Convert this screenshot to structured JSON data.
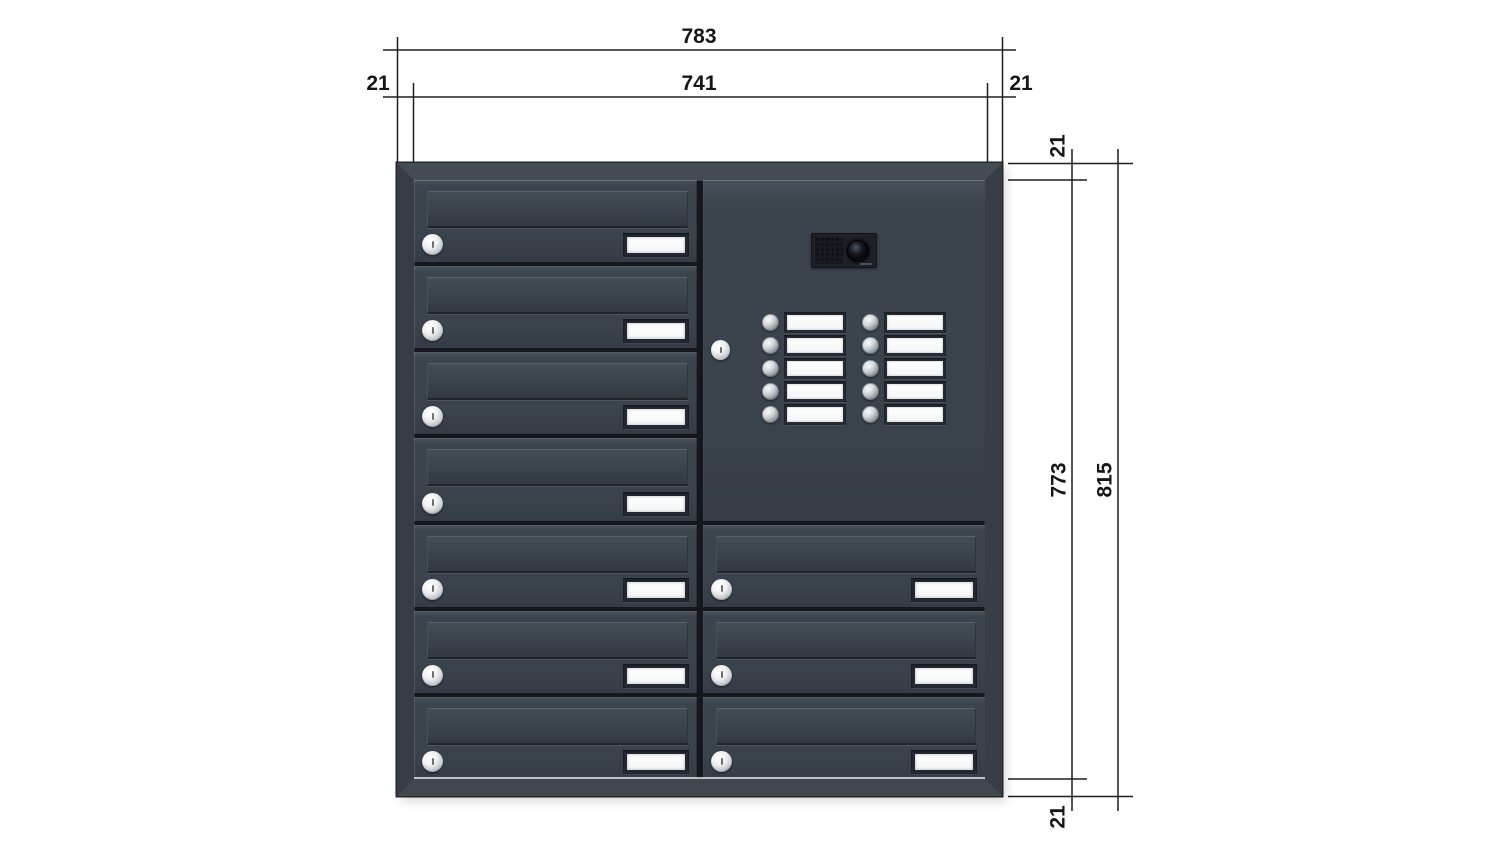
{
  "diagram": {
    "title": "mailbox-unit-dimensioned-drawing",
    "description": "Anthracite wall letterbox bank: 7 mailbox doors left column, intercom panel with camera and 10 bell buttons plus 3 mailbox doors right column, with dimension annotations"
  },
  "dimensions": {
    "top": {
      "overall_width": "783",
      "inner_width": "741",
      "left_margin": "21",
      "right_margin": "21"
    },
    "right": {
      "top_margin": "21",
      "inner_height": "773",
      "overall_height": "815",
      "bottom_margin": "21"
    }
  },
  "product": {
    "left_column_doors": 7,
    "right_column_doors": 3,
    "bell_button_rows": 5,
    "bell_button_columns": 2,
    "has_camera_module": true,
    "door_features": [
      "letter-slot",
      "lock-cylinder",
      "name-plate"
    ]
  },
  "colors": {
    "background": "#ffffff",
    "body": "#3a424b",
    "frame_top": "#454c53",
    "frame_side": "#363d44",
    "panel_gap": "#14171b",
    "dimension_line": "#1f1f1f",
    "lock_cylinder": "#d9dcdf",
    "name_plate": "#fbfcfd",
    "camera_module": "#1d2126"
  }
}
